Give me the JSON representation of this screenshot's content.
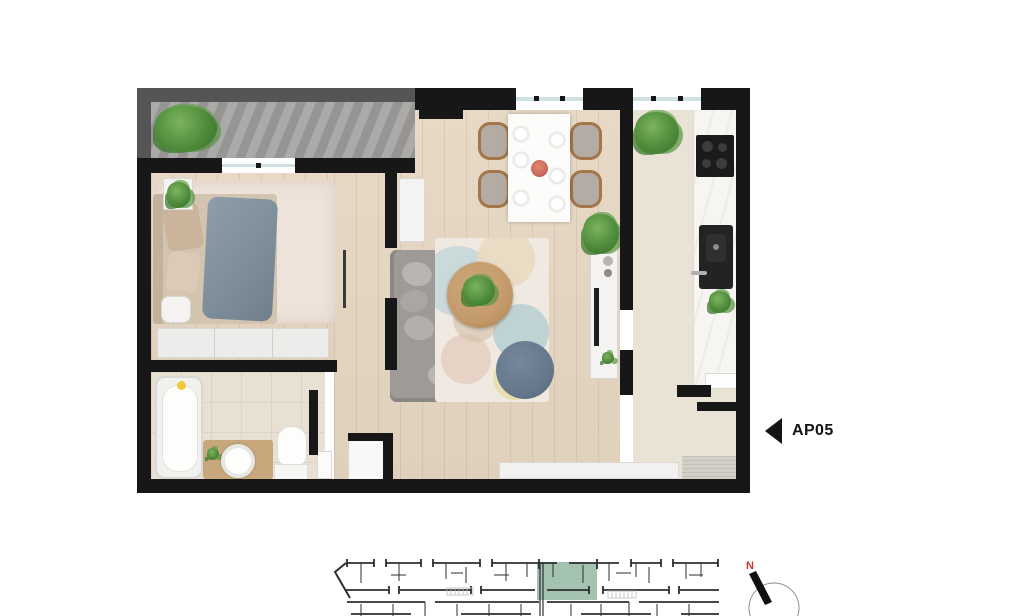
{
  "apartment_marker": {
    "label": "AP05"
  },
  "compass": {
    "north_label": "N"
  },
  "colors": {
    "wall": "#171717",
    "wood_floor": "#e6d7c2",
    "tile_floor": "#e7e0d3",
    "balcony_stone": "#a1a09e",
    "window_glass": "#cfe0e2",
    "minimap_highlight": "#a3c2af",
    "compass_north": "#c0392b"
  }
}
